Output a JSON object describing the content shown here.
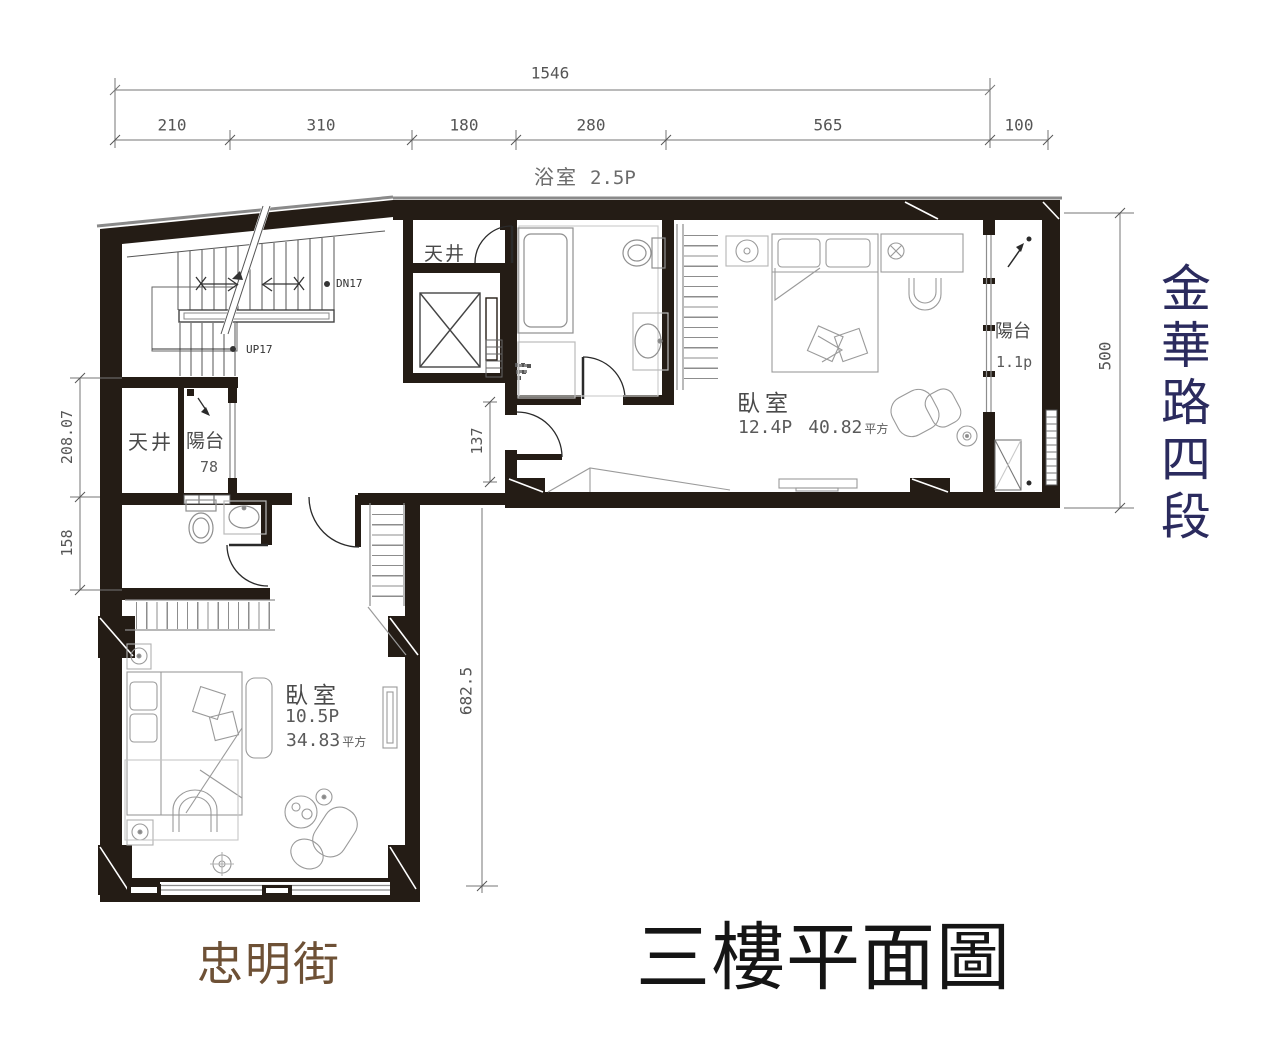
{
  "title": "三樓平面圖",
  "streets": {
    "south": "忠明街",
    "east": "金華路四段"
  },
  "dims": {
    "total": "1546",
    "segments": [
      "210",
      "310",
      "180",
      "280",
      "565",
      "100"
    ],
    "left_upper": "208.07",
    "left_lower": "158",
    "corridor": "137",
    "lower_wing": "682.5",
    "right_side": "500"
  },
  "rooms": {
    "bath_main": {
      "name": "浴室",
      "size": "2.5P"
    },
    "lightwell_nw": "天井",
    "balcony_nw": {
      "name": "陽台",
      "size": "78"
    },
    "lightwell_core": "天井",
    "bedroom_e": {
      "name": "臥室",
      "size": "12.4P",
      "area": "40.82",
      "unit": "平方"
    },
    "balcony_e": {
      "name": "陽台",
      "size": "1.1p"
    },
    "bedroom_s": {
      "name": "臥室",
      "size": "10.5P",
      "area": "34.83",
      "unit": "平方"
    }
  },
  "stairs": {
    "down": "DN17",
    "up": "UP17"
  },
  "colors": {
    "wall": "#241c15",
    "furniture_line": "#9a9a9a",
    "dimension_line": "#767676",
    "street_east_text": "#2b2b5e",
    "street_south_text": "#6e5136",
    "title_text": "#151515"
  }
}
